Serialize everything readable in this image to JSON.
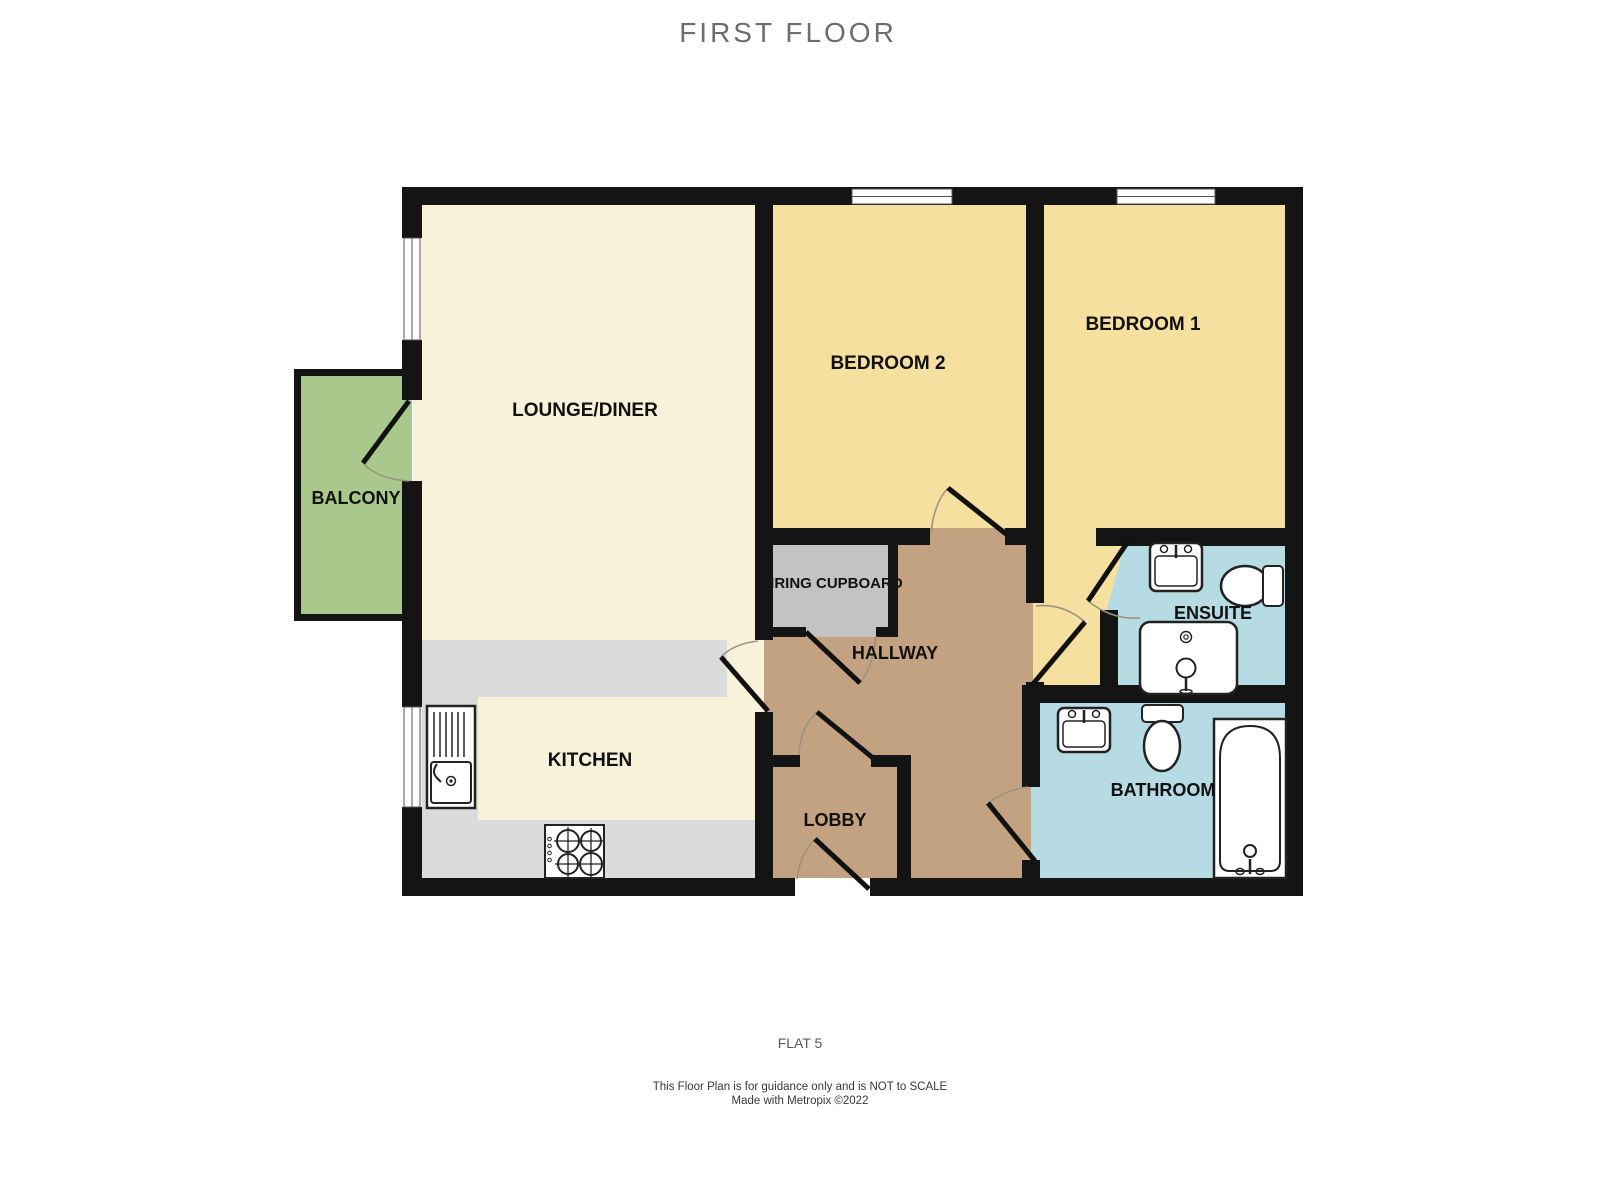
{
  "title": "FIRST FLOOR",
  "rooms": {
    "lounge": "LOUNGE/DINER",
    "balcony": "BALCONY",
    "bedroom2": "BEDROOM 2",
    "bedroom1": "BEDROOM 1",
    "airing_cupboard": "AIRING CUPBOARD",
    "hallway": "HALLWAY",
    "ensuite": "ENSUITE",
    "kitchen": "KITCHEN",
    "lobby": "LOBBY",
    "bathroom": "BATHROOM"
  },
  "footer": {
    "flat": "FLAT 5",
    "disclaimer_line1": "This Floor Plan is for guidance only and is NOT to SCALE",
    "disclaimer_line2": "Made with Metropix ©2022"
  },
  "colors": {
    "wall": "#141414",
    "lounge_floor": "#f8f2da",
    "bedroom_floor": "#f5e0a0",
    "balcony_floor": "#a9c98c",
    "hallway_floor": "#c2a280",
    "cupboard_floor": "#c3c3c3",
    "counter_gray": "#dbdbdb",
    "bathroom_floor": "#b7dbe3",
    "title_gray": "#6a6e71"
  }
}
